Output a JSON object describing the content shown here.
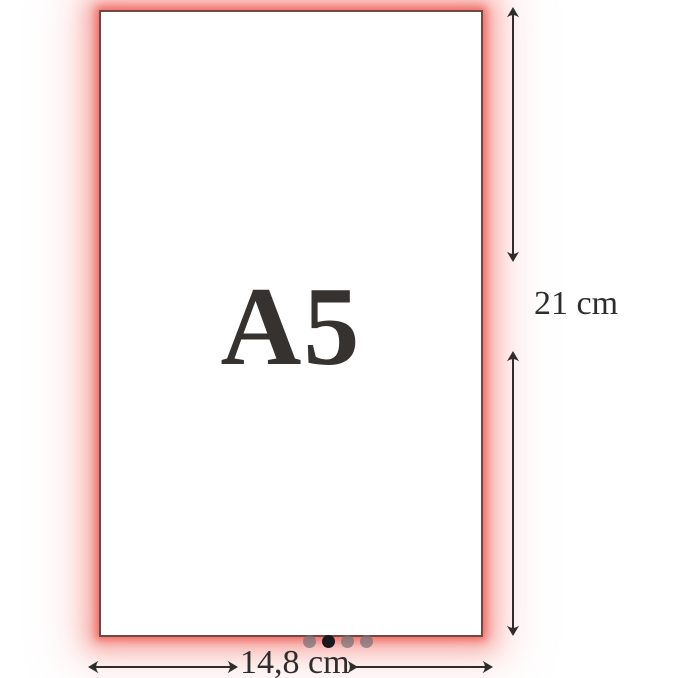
{
  "figure": {
    "paper_label": "A5",
    "height_label": "21 cm",
    "width_label": "14,8 cm"
  },
  "carousel": {
    "count": 4,
    "active_index": 1,
    "dots": [
      "inactive",
      "active",
      "inactive",
      "inactive"
    ]
  },
  "colors": {
    "glow": "#f3756f",
    "paper_border": "#6f4a45",
    "ink": "#2f2d2b",
    "dot_active": "#17191f",
    "dot_inactive": "#707076"
  }
}
